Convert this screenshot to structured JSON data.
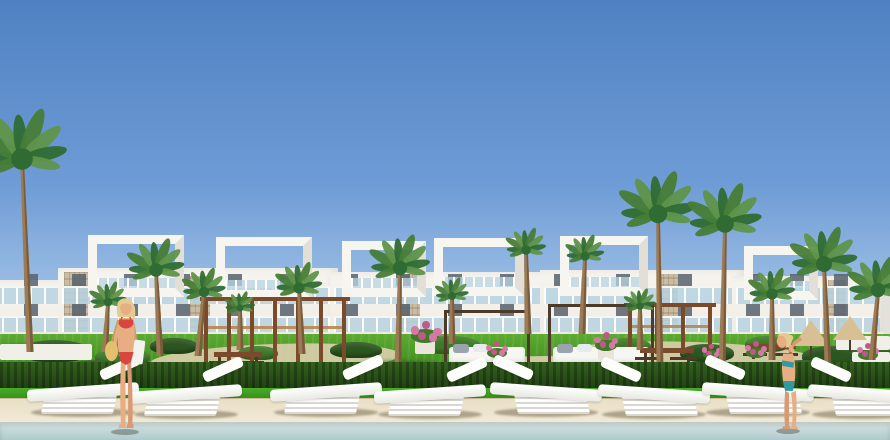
{
  "scene": {
    "caption": "Architectural rendering of a white modern villa complex with rooftop pergola frames, palm trees, garden cabanas, white sun loungers on a beige pool deck, a swimming pool in the foreground, a woman in a red bikini on the left and a woman in a teal bikini on the right.",
    "colors": {
      "sky_top": "#4f81c2",
      "sky_mid": "#6f9cd6",
      "sky_low": "#a6c6e8",
      "horizon": "#cfe0f2",
      "building_white": "#f6f4ee",
      "building_shade": "#e6e3d9",
      "frame_white": "#f7f5f0",
      "glass": "#b9d4e4",
      "window_dark": "#57626c",
      "stone": "#c9bca2",
      "stone_line": "rgba(120,105,80,0.25)",
      "lawn_top": "#5caa30",
      "lawn_bottom": "#2e7a18",
      "front_lawn_top": "#49ad27",
      "front_lawn_bottom": "#2f8c17",
      "hedge_top": "#34621f",
      "hedge_bottom": "#203f12",
      "shrub_dark": "#2c5620",
      "shrub_mid": "#3f7a2a",
      "path": "#dccfae",
      "deck_top": "#e9dfc7",
      "deck_bottom": "#f2ead6",
      "deck_edge": "#cfc19e",
      "water_top": "#d7e3e1",
      "water_bottom": "#aecbce",
      "palm_dark": "#2f6b33",
      "palm_mid": "#477d36",
      "palm_light": "#5f944a",
      "trunk": "#9b7a54",
      "trunk_dark": "#7a5c3c",
      "wood_dark": "#4e3a28",
      "wood_mid": "#7b4a2a",
      "wood_light": "#b9854e",
      "mattress": "#f6f6f2",
      "pillow": "#9aa4ae",
      "lounger_white": "#fdfdfb",
      "lounger_slat": "#d8d7d0",
      "lounger_shadow": "rgba(110,98,70,0.5)",
      "skin": "#e7ad83",
      "skin_dark": "#d79a72",
      "hair_blonde": "#e3cc92",
      "bikini_red": "#d9453f",
      "bikini_teal": "#2f9aa0",
      "bag_yellow": "#e3c06e",
      "towel": "#f3f3ee",
      "flower_a": "#d678a4",
      "flower_b": "#c05888",
      "pot_white": "#e9e5da",
      "parasol_tan": "#d8c094",
      "white_structure": "#f0efe8",
      "ground_shadow": "rgba(25,70,20,0.38)"
    },
    "buildings": {
      "backdrop": {
        "y": 296,
        "h": 60
      },
      "floor_y": [
        286,
        316
      ],
      "modules": [
        {
          "x": -30,
          "w": 100,
          "bodyTop": 280,
          "frames": [],
          "panels": []
        },
        {
          "x": 58,
          "w": 280,
          "bodyTop": 268,
          "frames": [
            {
              "dx": 30,
              "w": 96,
              "top": 235,
              "h": 62
            },
            {
              "dx": 158,
              "w": 96,
              "top": 237,
              "h": 62
            }
          ],
          "panels": [
            {
              "dx": 6,
              "y": 272,
              "w": 24,
              "h": 92
            },
            {
              "dx": 132,
              "y": 276,
              "w": 20,
              "h": 80
            }
          ]
        },
        {
          "x": 330,
          "w": 228,
          "bodyTop": 272,
          "frames": [
            {
              "dx": 12,
              "w": 84,
              "top": 241,
              "h": 56
            },
            {
              "dx": 104,
              "w": 90,
              "top": 238,
              "h": 58
            }
          ],
          "panels": [
            {
              "dx": 72,
              "y": 274,
              "w": 18,
              "h": 84
            }
          ]
        },
        {
          "x": 540,
          "w": 206,
          "bodyTop": 270,
          "frames": [
            {
              "dx": 20,
              "w": 88,
              "top": 236,
              "h": 60
            }
          ],
          "panels": [
            {
              "dx": 118,
              "y": 274,
              "w": 20,
              "h": 82
            }
          ]
        },
        {
          "x": 732,
          "w": 152,
          "bodyTop": 276,
          "frames": [
            {
              "dx": 12,
              "w": 74,
              "top": 246,
              "h": 54
            }
          ],
          "panels": [
            {
              "dx": 96,
              "y": 280,
              "w": 18,
              "h": 70
            }
          ]
        }
      ]
    },
    "garden": {
      "band": {
        "y": 334,
        "h": 56
      },
      "paths": [
        {
          "x": 150,
          "y": 344,
          "w": 250,
          "h": 30,
          "r": -2
        },
        {
          "x": 470,
          "y": 356,
          "w": 150,
          "h": 20,
          "r": 0
        },
        {
          "x": 575,
          "y": 342,
          "w": 240,
          "h": 26,
          "r": 2
        },
        {
          "x": 368,
          "y": 372,
          "w": 160,
          "h": 16,
          "r": 0
        }
      ],
      "shrubs": [
        {
          "x": 20,
          "y": 340,
          "w": 70,
          "h": 22,
          "c": "dark"
        },
        {
          "x": 95,
          "y": 348,
          "w": 55,
          "h": 18,
          "c": "mid"
        },
        {
          "x": 150,
          "y": 338,
          "w": 48,
          "h": 16,
          "c": "dark"
        },
        {
          "x": 238,
          "y": 346,
          "w": 40,
          "h": 14,
          "c": "mid"
        },
        {
          "x": 330,
          "y": 342,
          "w": 52,
          "h": 16,
          "c": "dark"
        },
        {
          "x": 420,
          "y": 336,
          "w": 60,
          "h": 18,
          "c": "mid"
        },
        {
          "x": 470,
          "y": 348,
          "w": 44,
          "h": 14,
          "c": "dark"
        },
        {
          "x": 605,
          "y": 338,
          "w": 46,
          "h": 16,
          "c": "mid"
        },
        {
          "x": 680,
          "y": 344,
          "w": 54,
          "h": 18,
          "c": "dark"
        },
        {
          "x": 745,
          "y": 336,
          "w": 44,
          "h": 16,
          "c": "mid"
        },
        {
          "x": 802,
          "y": 346,
          "w": 60,
          "h": 20,
          "c": "dark"
        },
        {
          "x": 858,
          "y": 338,
          "w": 40,
          "h": 16,
          "c": "mid"
        },
        {
          "x": 60,
          "y": 360,
          "w": 80,
          "h": 20,
          "c": "dark"
        },
        {
          "x": 350,
          "y": 362,
          "w": 60,
          "h": 16,
          "c": "mid"
        },
        {
          "x": 500,
          "y": 364,
          "w": 70,
          "h": 16,
          "c": "dark"
        },
        {
          "x": 770,
          "y": 360,
          "w": 70,
          "h": 18,
          "c": "dark"
        }
      ],
      "palm_shadows": [
        {
          "x": -14,
          "y": 344,
          "w": 80,
          "h": 10
        },
        {
          "x": 356,
          "y": 360,
          "w": 84,
          "h": 10
        },
        {
          "x": 612,
          "y": 364,
          "w": 92,
          "h": 11
        },
        {
          "x": 676,
          "y": 366,
          "w": 92,
          "h": 11
        },
        {
          "x": 788,
          "y": 362,
          "w": 80,
          "h": 10
        }
      ]
    },
    "structures": {
      "pergolas": [
        {
          "x": 204,
          "y": 300,
          "w": 142,
          "h": 66,
          "posts": 7
        },
        {
          "x": 628,
          "y": 306,
          "w": 84,
          "h": 48,
          "posts": 4
        }
      ],
      "cabanas": [
        {
          "x": 444,
          "y": 310,
          "w": 86,
          "h": 60
        },
        {
          "x": 548,
          "y": 304,
          "w": 106,
          "h": 66
        }
      ],
      "picnic_tables": [
        {
          "x": 214,
          "y": 352,
          "w": 48
        },
        {
          "x": 640,
          "y": 348,
          "w": 54
        },
        {
          "x": 748,
          "y": 344,
          "w": 48
        }
      ],
      "parasols": [
        {
          "x": 793,
          "y": 320,
          "w": 36,
          "h": 26
        },
        {
          "x": 833,
          "y": 316,
          "w": 34,
          "h": 24
        }
      ],
      "white_structures": [
        {
          "x": 0,
          "y": 344,
          "w": 92,
          "h": 16
        },
        {
          "x": 836,
          "y": 336,
          "w": 54,
          "h": 14
        },
        {
          "x": 852,
          "y": 352,
          "w": 38,
          "h": 10
        }
      ],
      "flowers": [
        {
          "x": 118,
          "y": 352,
          "s": 1.0,
          "pot": false
        },
        {
          "x": 425,
          "y": 332,
          "s": 1.4,
          "pot": true
        },
        {
          "x": 497,
          "y": 350,
          "s": 1.0,
          "pot": true
        },
        {
          "x": 606,
          "y": 342,
          "s": 1.1,
          "pot": true
        },
        {
          "x": 712,
          "y": 352,
          "s": 0.9,
          "pot": false
        },
        {
          "x": 756,
          "y": 350,
          "s": 1.0,
          "pot": false
        },
        {
          "x": 868,
          "y": 352,
          "s": 1.0,
          "pot": false
        }
      ]
    },
    "palms": [
      {
        "x": 30,
        "y": 352,
        "h": 185,
        "c": 54,
        "lean": -8
      },
      {
        "x": 105,
        "y": 352,
        "h": 42,
        "c": 22,
        "lean": 3
      },
      {
        "x": 160,
        "y": 356,
        "h": 78,
        "c": 34,
        "lean": -4
      },
      {
        "x": 198,
        "y": 356,
        "h": 56,
        "c": 26,
        "lean": 6
      },
      {
        "x": 240,
        "y": 350,
        "h": 34,
        "c": 18,
        "lean": 0
      },
      {
        "x": 302,
        "y": 354,
        "h": 58,
        "c": 28,
        "lean": -3
      },
      {
        "x": 398,
        "y": 366,
        "h": 90,
        "c": 36,
        "lean": 2
      },
      {
        "x": 452,
        "y": 344,
        "h": 40,
        "c": 20,
        "lean": 0
      },
      {
        "x": 528,
        "y": 334,
        "h": 76,
        "c": 24,
        "lean": -2
      },
      {
        "x": 582,
        "y": 334,
        "h": 70,
        "c": 23,
        "lean": 3
      },
      {
        "x": 640,
        "y": 350,
        "h": 36,
        "c": 19,
        "lean": 0
      },
      {
        "x": 660,
        "y": 370,
        "h": 148,
        "c": 46,
        "lean": -2
      },
      {
        "x": 722,
        "y": 372,
        "h": 140,
        "c": 44,
        "lean": 3
      },
      {
        "x": 772,
        "y": 360,
        "h": 58,
        "c": 28,
        "lean": 0
      },
      {
        "x": 828,
        "y": 368,
        "h": 96,
        "c": 40,
        "lean": -4
      },
      {
        "x": 872,
        "y": 360,
        "h": 62,
        "c": 36,
        "lean": 6
      }
    ],
    "hedge": {
      "y": 362,
      "h": 28
    },
    "front_lawn": {
      "y": 388,
      "h": 12,
      "left_wedge": {
        "x": 0,
        "y": 398,
        "w": 140,
        "h": 14
      }
    },
    "deck": {
      "y": 398,
      "h": 24
    },
    "water": {
      "y": 422,
      "h": 18
    },
    "loungers": {
      "w": 120,
      "h": 48,
      "items": [
        {
          "x": 25,
          "y": 372,
          "flip": false
        },
        {
          "x": 128,
          "y": 374,
          "flip": false
        },
        {
          "x": 268,
          "y": 372,
          "flip": false
        },
        {
          "x": 372,
          "y": 374,
          "flip": false
        },
        {
          "x": 488,
          "y": 372,
          "flip": true
        },
        {
          "x": 596,
          "y": 374,
          "flip": true
        },
        {
          "x": 700,
          "y": 372,
          "flip": true
        },
        {
          "x": 806,
          "y": 374,
          "flip": true
        }
      ]
    },
    "people": [
      {
        "type": "woman-red-bikini",
        "x": 97,
        "y": 294,
        "w": 58,
        "h": 142
      },
      {
        "type": "woman-teal-bikini",
        "x": 766,
        "y": 330,
        "w": 50,
        "h": 106
      }
    ]
  }
}
